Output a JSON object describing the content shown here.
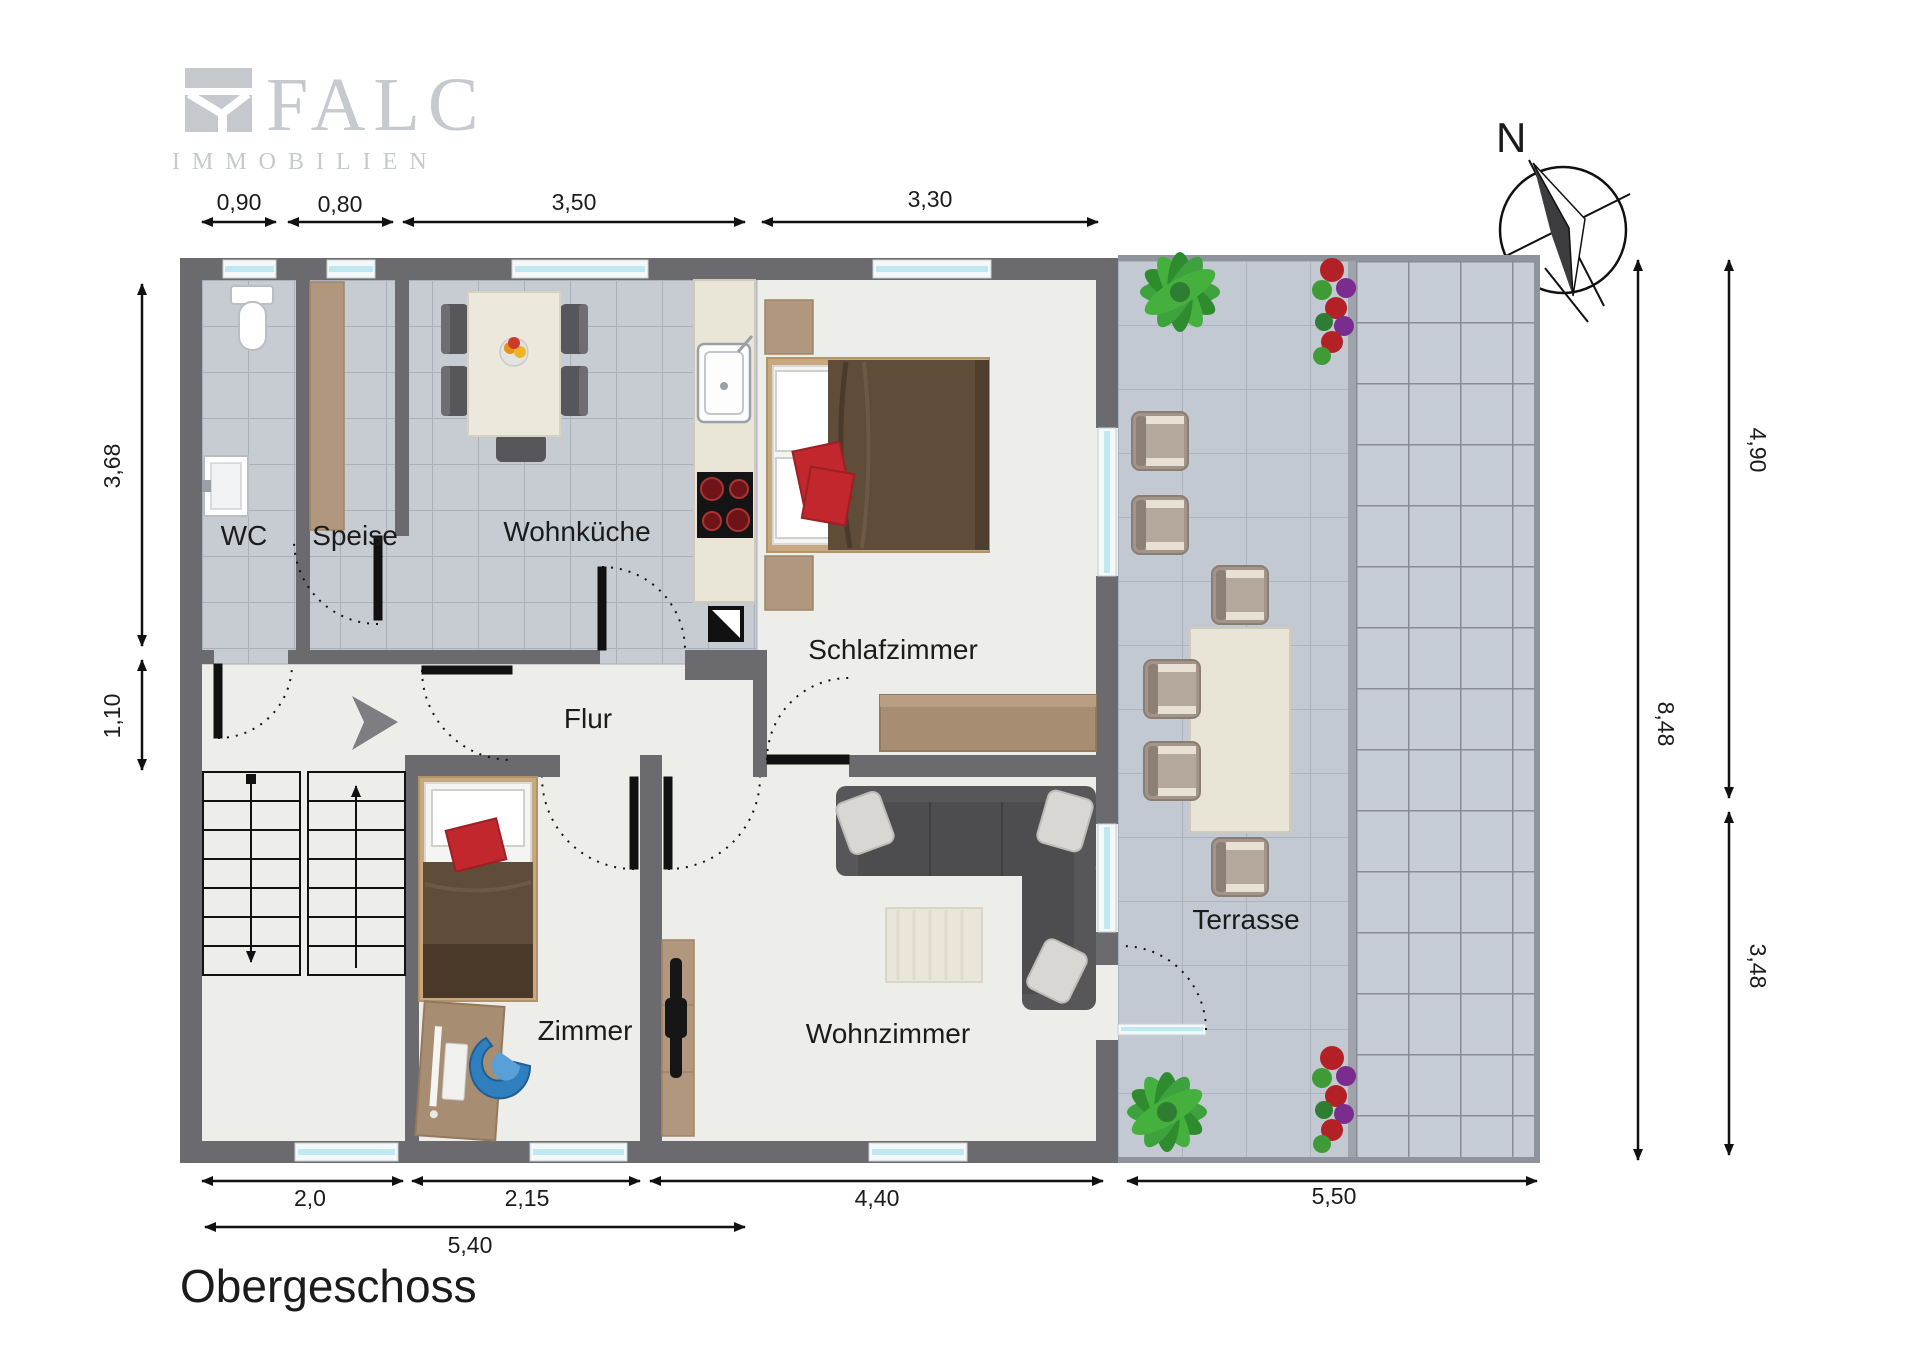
{
  "branding": {
    "logo_text": "FALC",
    "logo_subtext": "IMMOBILIEN"
  },
  "title": "Obergeschoss",
  "compass": {
    "label": "N"
  },
  "rooms": [
    {
      "label": "WC"
    },
    {
      "label": "Speise"
    },
    {
      "label": "Wohnküche"
    },
    {
      "label": "Schlafzimmer"
    },
    {
      "label": "Flur"
    },
    {
      "label": "Zimmer"
    },
    {
      "label": "Wohnzimmer"
    },
    {
      "label": "Terrasse"
    }
  ],
  "dimensions": {
    "top": [
      {
        "value": "0,90"
      },
      {
        "value": "0,80"
      },
      {
        "value": "3,50"
      },
      {
        "value": "3,30"
      }
    ],
    "left": [
      {
        "value": "3,68"
      },
      {
        "value": "1,10"
      }
    ],
    "right": [
      {
        "value": "4,90"
      },
      {
        "value": "8,48"
      },
      {
        "value": "3,48"
      }
    ],
    "bottom": [
      {
        "value": "2,0"
      },
      {
        "value": "2,15"
      },
      {
        "value": "4,40"
      },
      {
        "value": "5,50"
      }
    ],
    "bottom_overall": [
      {
        "value": "5,40"
      }
    ]
  },
  "colors": {
    "wall": "#6a6a6f",
    "tile_floor": "#c7ccd3",
    "room_floor": "#edeee9",
    "terrace_tile": "#c3c9d2",
    "terrace_tile_right": "#c7cdd6",
    "window_glass": "#bfe9f0",
    "wood": "#b1977d",
    "bed_blanket": "#5f4c39",
    "accent_red": "#c1272d",
    "sofa": "#57575a",
    "logo_gray": "#c6c9cd",
    "plant_green": "#3da row23d"
  }
}
